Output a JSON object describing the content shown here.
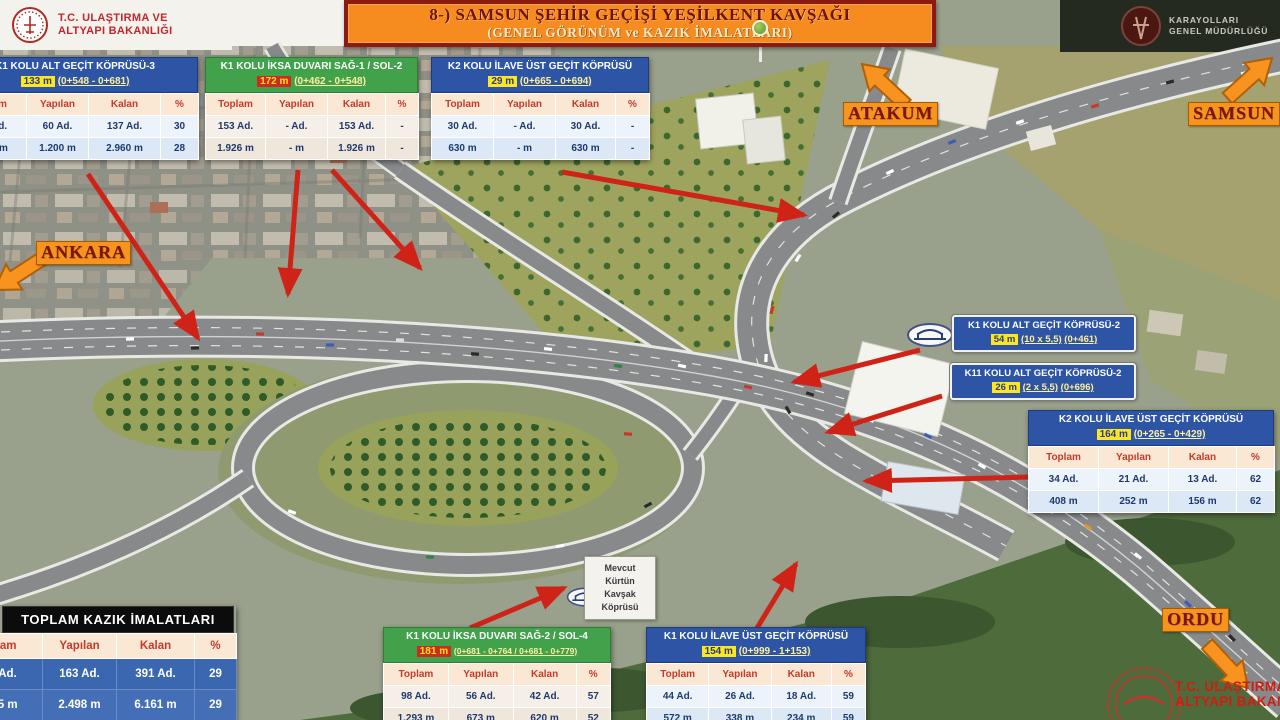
{
  "title": {
    "line1": "8-) SAMSUN ŞEHİR GEÇİŞİ YEŞİLKENT KAVŞAĞI",
    "line2": "(GENEL GÖRÜNÜM ve KAZIK İMALATLARI)"
  },
  "logos": {
    "ministry_top_left": {
      "line1": "T.C. ULAŞTIRMA VE",
      "line2": "ALTYAPI BAKANLIĞI"
    },
    "kgm_top_right": {
      "line1": "KARAYOLLARI",
      "line2": "GENEL MÜDÜRLÜĞÜ"
    },
    "ministry_bottom_right": {
      "line1": "T.C. ULAŞTIRMA VE",
      "line2": "ALTYAPI BAKANLIĞI"
    }
  },
  "columns": [
    "Toplam",
    "Yapılan",
    "Kalan",
    "%"
  ],
  "tables": {
    "k1_alt_gecit_3": {
      "title": "K1 KOLU ALT GEÇİT KÖPRÜSÜ-3",
      "length": "133 m",
      "stations": "(0+548 - 0+681)",
      "rows": [
        [
          "197 Ad.",
          "60 Ad.",
          "137 Ad.",
          "30"
        ],
        [
          "4.160 m",
          "1.200 m",
          "2.960 m",
          "28"
        ]
      ]
    },
    "k1_iksa_sag1_sol2": {
      "title": "K1 KOLU İKSA DUVARI SAĞ-1 / SOL-2",
      "length": "172 m",
      "stations": "(0+462 - 0+548)",
      "rows": [
        [
          "153 Ad.",
          "- Ad.",
          "153 Ad.",
          "-"
        ],
        [
          "1.926 m",
          "- m",
          "1.926 m",
          "-"
        ]
      ]
    },
    "k2_ilave_ust_kucuk": {
      "title": "K2 KOLU İLAVE ÜST GEÇİT KÖPRÜSÜ",
      "length": "29 m",
      "stations": "(0+665 - 0+694)",
      "rows": [
        [
          "30 Ad.",
          "- Ad.",
          "30 Ad.",
          "-"
        ],
        [
          "630 m",
          "- m",
          "630 m",
          "-"
        ]
      ]
    },
    "k2_ilave_ust": {
      "title": "K2 KOLU İLAVE ÜST GEÇİT KÖPRÜSÜ",
      "length": "164 m",
      "stations": "(0+265 - 0+429)",
      "rows": [
        [
          "34 Ad.",
          "21 Ad.",
          "13 Ad.",
          "62"
        ],
        [
          "408 m",
          "252 m",
          "156 m",
          "62"
        ]
      ]
    },
    "toplam_kazik": {
      "title": "TOPLAM KAZIK İMALATLARI",
      "rows": [
        [
          "556 Ad.",
          "163 Ad.",
          "391 Ad.",
          "29"
        ],
        [
          "8.685 m",
          "2.498 m",
          "6.161 m",
          "29"
        ]
      ]
    },
    "k1_iksa_sag2_sol4": {
      "title": "K1 KOLU İKSA DUVARI SAĞ-2 / SOL-4",
      "length": "181 m",
      "stations": "(0+681 - 0+764 / 0+681 - 0+779)",
      "rows": [
        [
          "98 Ad.",
          "56 Ad.",
          "42 Ad.",
          "57"
        ],
        [
          "1.293 m",
          "673 m",
          "620 m",
          "52"
        ]
      ]
    },
    "k1_ilave_ust": {
      "title": "K1 KOLU İLAVE ÜST GEÇİT KÖPRÜSÜ",
      "length": "154 m",
      "stations": "(0+999 - 1+153)",
      "rows": [
        [
          "44 Ad.",
          "26 Ad.",
          "18 Ad.",
          "59"
        ],
        [
          "572 m",
          "338 m",
          "234 m",
          "59"
        ]
      ]
    }
  },
  "bridge_labels": [
    {
      "title": "K1 KOLU ALT GEÇİT KÖPRÜSÜ-2",
      "length": "54 m",
      "dims": "(10 x 5,5)",
      "station": "(0+461)"
    },
    {
      "title": "K11 KOLU ALT GEÇİT KÖPRÜSÜ-2",
      "length": "26 m",
      "dims": "(2 x 5,5)",
      "station": "(0+696)"
    }
  ],
  "map_note": {
    "line1": "Mevcut",
    "line2": "Kürtün",
    "line3": "Kavşak",
    "line4": "Köprüsü"
  },
  "directions": {
    "west": "ANKARA",
    "north": "ATAKUM",
    "northeast": "SAMSUN",
    "southeast": "ORDU"
  },
  "colors": {
    "banner_orange": "#f68b1f",
    "banner_border": "#8c1a0e",
    "header_blue": "#2e54a5",
    "header_green": "#41a24b",
    "highlight_yellow": "#ffe51c",
    "highlight_red": "#cf2a1b",
    "annotation_arrow_red": "#cf2318",
    "direction_orange": "#f7941d"
  }
}
